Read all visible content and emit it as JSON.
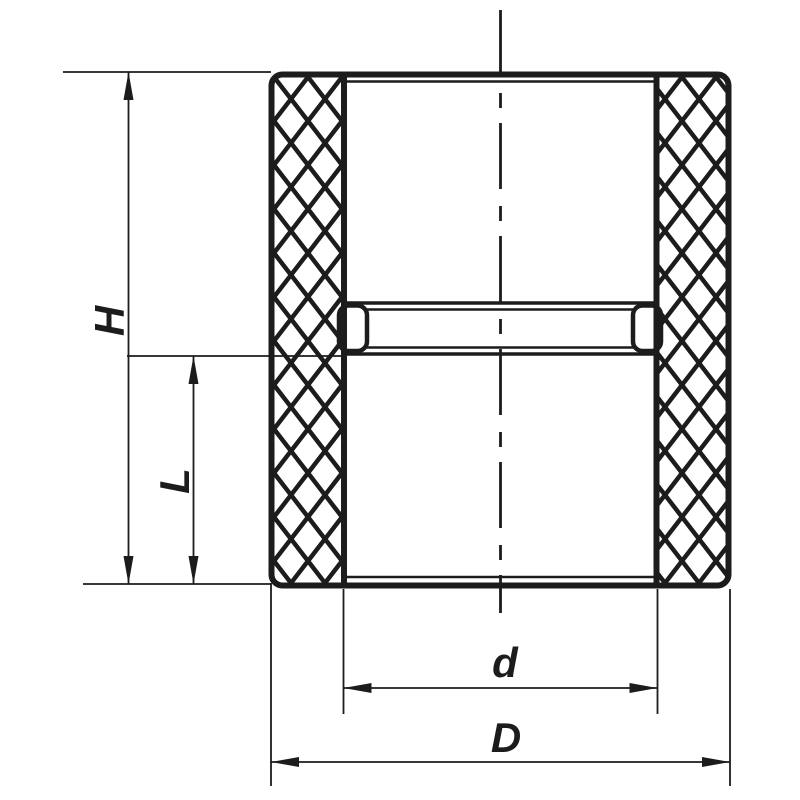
{
  "drawing": {
    "kind": "technical-drawing",
    "subject": "pipe coupling socket cross-section",
    "line_color": "#1c1c1c",
    "background_color": "#ffffff"
  },
  "dimensions": {
    "overall_height": {
      "label": "H"
    },
    "socket_depth": {
      "label": "L"
    },
    "inner_diameter": {
      "label": "d"
    },
    "outer_diameter": {
      "label": "D"
    }
  }
}
